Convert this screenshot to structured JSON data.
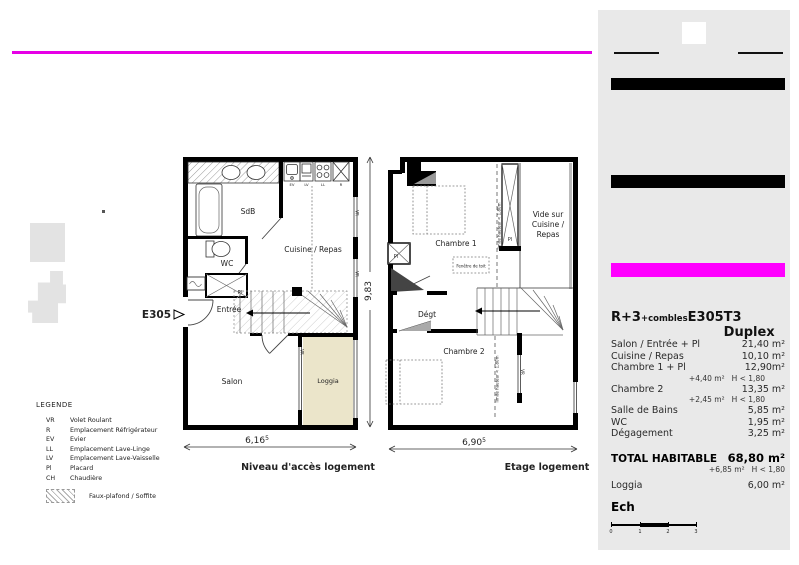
{
  "colors": {
    "accent_magenta": "#ff00ff",
    "loggia_fill": "#ebe5ca"
  },
  "legend": {
    "title": "LEGENDE",
    "items": [
      {
        "abbr": "VR",
        "label": "Volet Roulant"
      },
      {
        "abbr": "R",
        "label": "Emplacement Réfrigérateur"
      },
      {
        "abbr": "EV",
        "label": "Evier"
      },
      {
        "abbr": "LL",
        "label": "Emplacement Lave-Linge"
      },
      {
        "abbr": "LV",
        "label": "Emplacement Lave-Vaisselle"
      },
      {
        "abbr": "Pl",
        "label": "Placard"
      },
      {
        "abbr": "CH",
        "label": "Chaudière"
      }
    ],
    "hatch_label": "Faux-plafond / Soffite"
  },
  "plans": {
    "left": {
      "caption": "Niveau d'accès logement",
      "unit_label": "E305",
      "width_dim": "6,16",
      "width_dim_sup": "5",
      "height_dim": "9,83",
      "rooms": {
        "sdb": "SdB",
        "wc": "WC",
        "entree": "Entrée",
        "salon": "Salon",
        "loggia": "Loggia",
        "cuisine": "Cuisine / Repas",
        "pl": "Pl"
      },
      "kitchen_labels": [
        "EV",
        "LV",
        "LL",
        "R"
      ],
      "vr": "VR"
    },
    "right": {
      "caption": "Etage logement",
      "width_dim": "6,90",
      "width_dim_sup": "5",
      "rooms": {
        "chambre1": "Chambre 1",
        "chambre2": "Chambre 2",
        "degt": "Dégt",
        "vide_line1": "Vide sur",
        "vide_line2": "Cuisine /",
        "vide_line3": "Repas",
        "pl": "Pl",
        "fenetre_toit": "Fenêtre de toit"
      },
      "limite": "limite hauteur < 1,80m",
      "vr": "VR"
    }
  },
  "panel": {
    "header": {
      "level": "R+3",
      "level_sub": "+combles",
      "unit": "E305",
      "type": "T3 Duplex"
    },
    "rows": [
      {
        "label": "Salon / Entrée + Pl",
        "value": "21,40 m²"
      },
      {
        "label": "Cuisine / Repas",
        "value": "10,10 m²"
      },
      {
        "label": "Chambre 1 + Pl",
        "value": "12,90m²",
        "sub_area": "+4,40 m²",
        "sub_cond": "H < 1,80"
      },
      {
        "label": "Chambre 2",
        "value": "13,35 m²",
        "sub_area": "+2,45 m²",
        "sub_cond": "H < 1,80"
      },
      {
        "label": "Salle de Bains",
        "value": "5,85 m²"
      },
      {
        "label": "WC",
        "value": "1,95 m²"
      },
      {
        "label": "Dégagement",
        "value": "3,25 m²"
      }
    ],
    "total": {
      "label": "TOTAL HABITABLE",
      "value": "68,80 m²",
      "sub_area": "+6,85 m²",
      "sub_cond": "H < 1,80"
    },
    "loggia": {
      "label": "Loggia",
      "value": "6,00 m²"
    },
    "scale": {
      "label": "Ech",
      "ticks": [
        "0",
        "1",
        "2",
        "3"
      ]
    }
  }
}
